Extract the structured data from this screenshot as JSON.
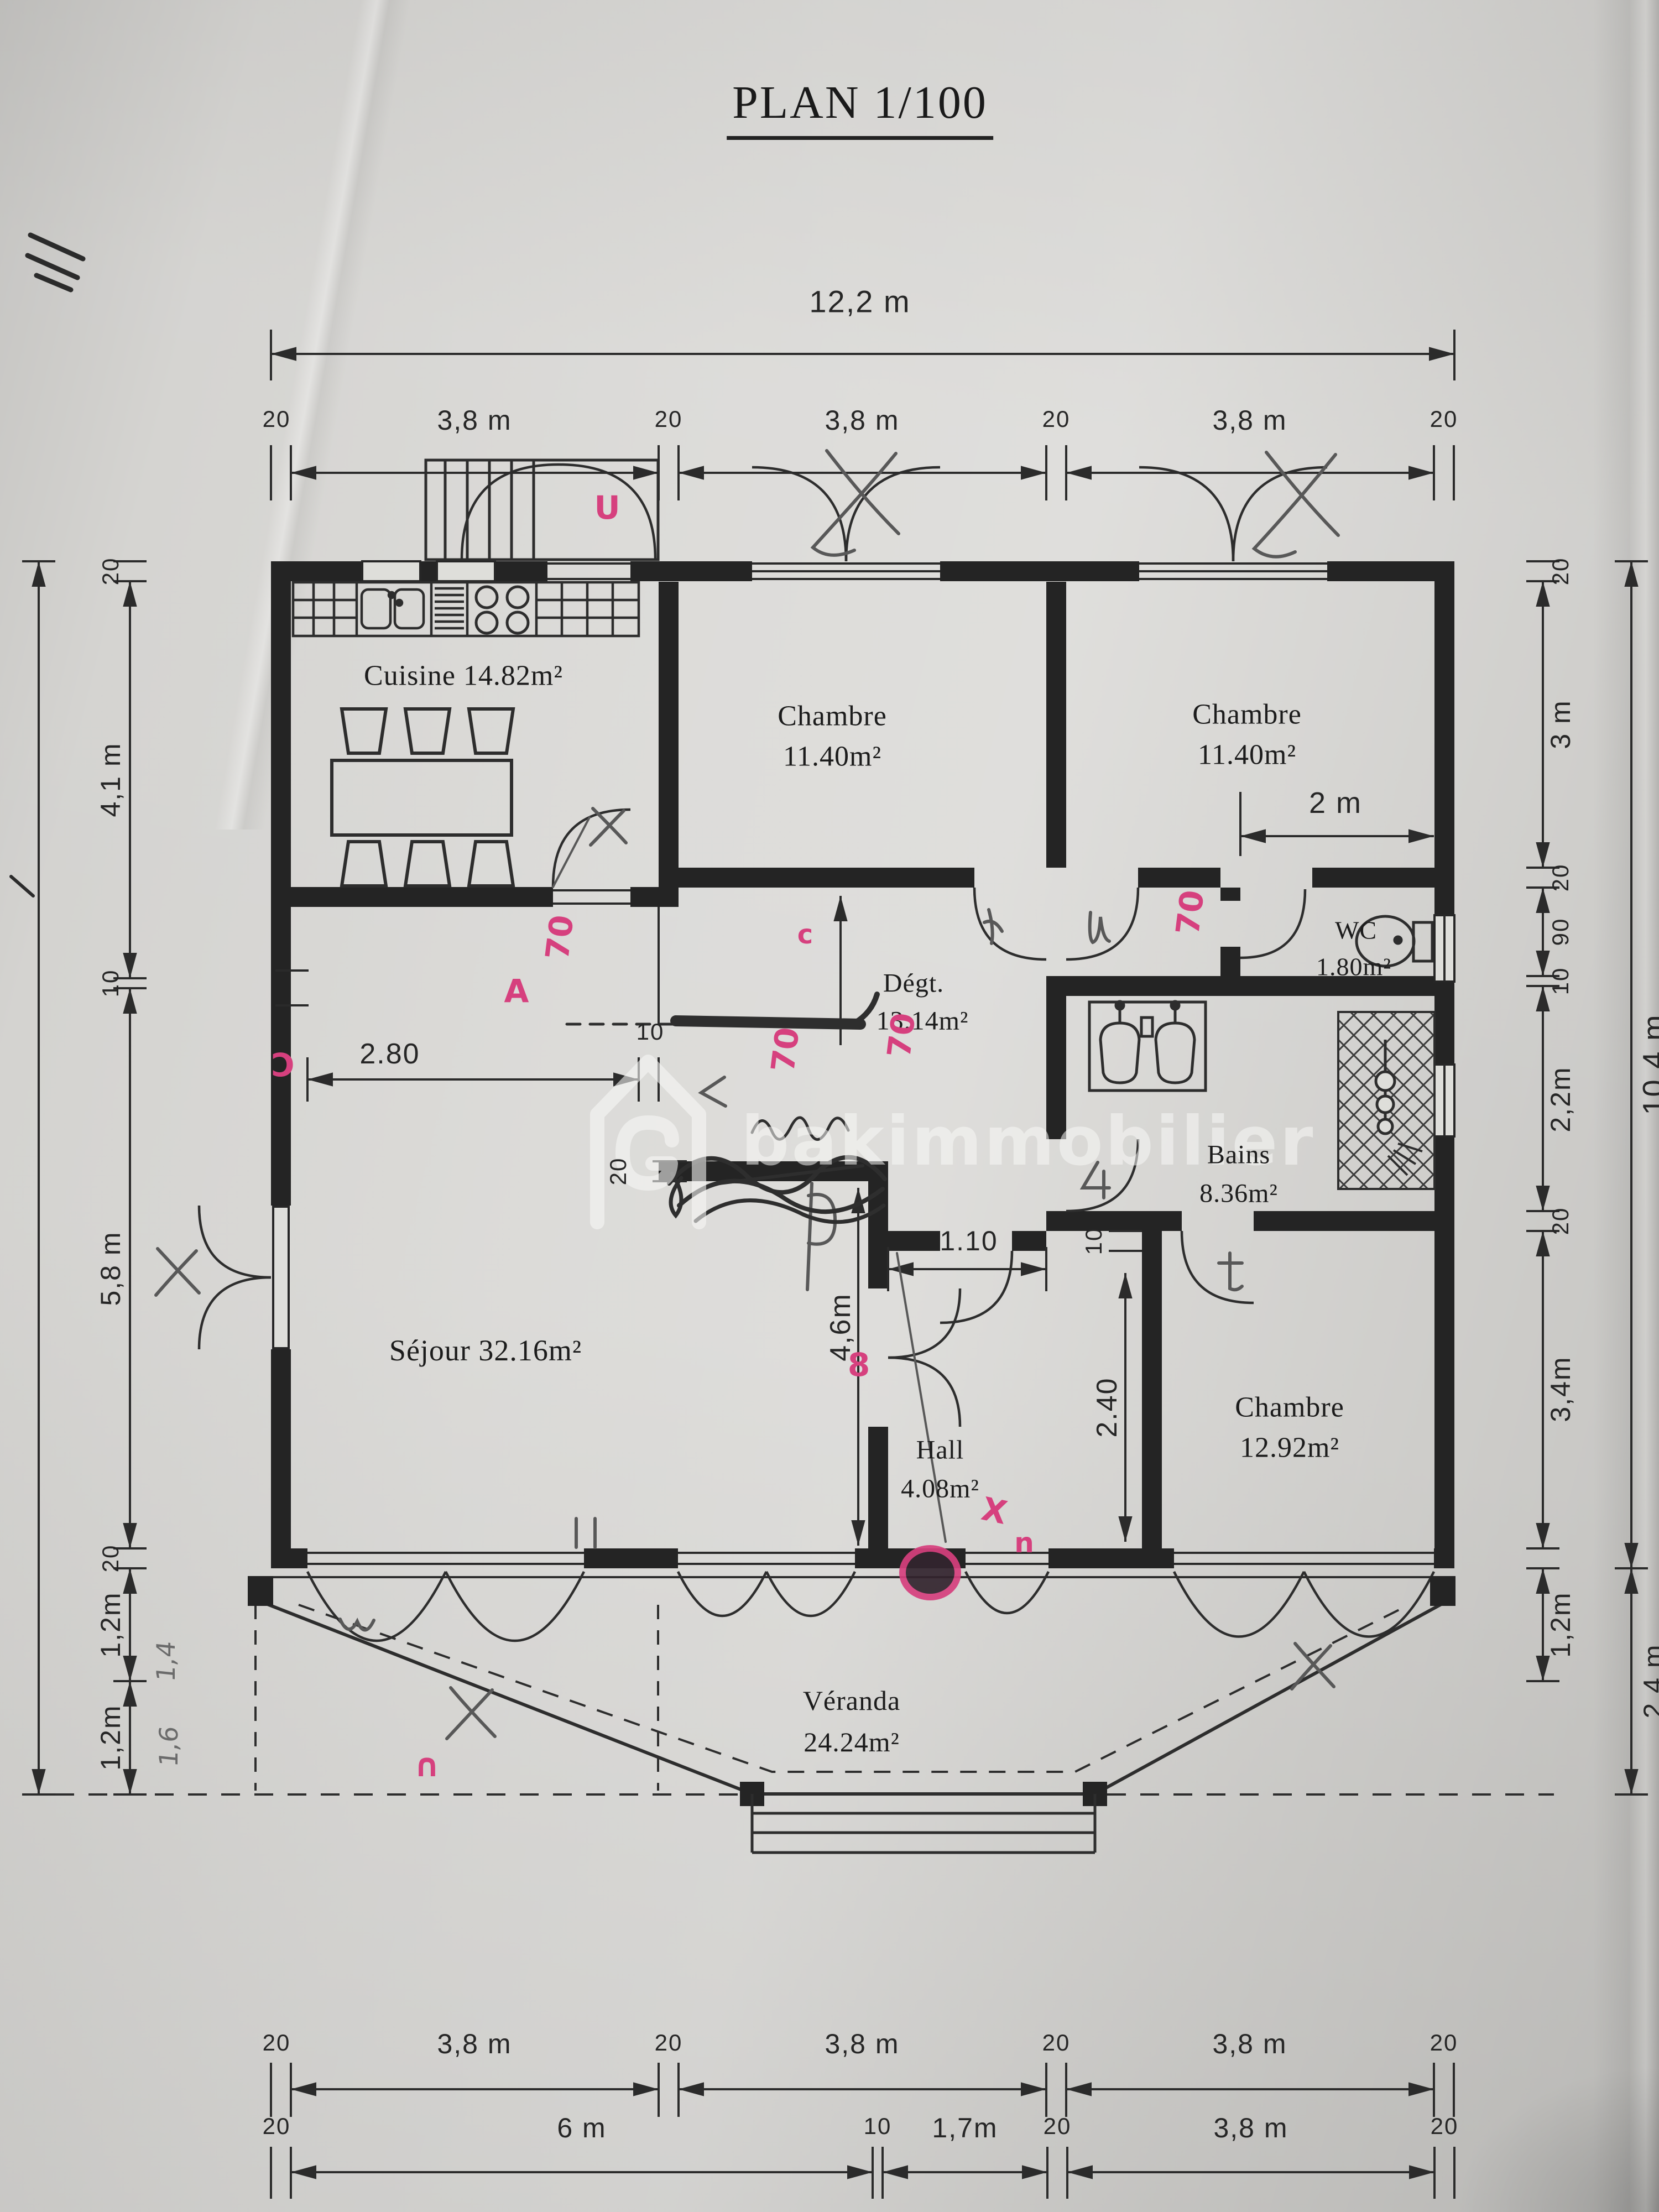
{
  "title": "PLAN 1/100",
  "dims": {
    "top_total": "12,2 m",
    "top_row": [
      "20",
      "3,8 m",
      "20",
      "3,8 m",
      "20",
      "3,8 m",
      "20"
    ],
    "bottom_row1": [
      "20",
      "3,8 m",
      "20",
      "3,8 m",
      "20",
      "3,8 m",
      "20"
    ],
    "bottom_row2": [
      "20",
      "6 m",
      "10",
      "1,7m",
      "20",
      "3,8 m",
      "20"
    ],
    "left_col": [
      "20",
      "4,1 m",
      "10",
      "5,8 m",
      "20",
      "1,2m",
      "1,2m"
    ],
    "right_col": [
      "20",
      "3 m",
      "20",
      "90",
      "10",
      "2,2m",
      "20",
      "3,4m",
      "1,2m"
    ],
    "right_outer": [
      "10,4 m",
      "2,4 m"
    ],
    "interior": {
      "chambre2_width": "2 m",
      "sejour_wall_offset": "2.80",
      "offset_wall_thickness": "10",
      "wall_thickness": "20",
      "corridor_width": "1.10",
      "hall_depth": "4,6m",
      "hall_wall_thickness": "10",
      "chambre3_recess": "2.40"
    }
  },
  "rooms": {
    "cuisine": {
      "label": "Cuisine 14.82m²"
    },
    "chambre_top_middle": {
      "name": "Chambre",
      "area": "11.40m²"
    },
    "chambre_top_right": {
      "name": "Chambre",
      "area": "11.40m²"
    },
    "wc": {
      "name": "WC",
      "area": "1.80m²"
    },
    "degagement": {
      "name": "Dégt.",
      "area": "13.14m²"
    },
    "bains": {
      "name": "Bains",
      "area": "8.36m²"
    },
    "sejour": {
      "label": "Séjour 32.16m²"
    },
    "hall": {
      "name": "Hall",
      "area": "4.08m²"
    },
    "chambre_bottom_right": {
      "name": "Chambre",
      "area": "12.92m²"
    },
    "veranda": {
      "name": "Véranda",
      "area": "24.24m²"
    }
  },
  "annotations": {
    "pink_door_width": "70",
    "pink_marks": {
      "porch": "U",
      "sejour_a": "A",
      "open_paren": "Ɔ",
      "small_c": "c",
      "eight": "8",
      "x_mark": "X",
      "n_mark": "n",
      "arch": "∩"
    },
    "pencil_notes": {
      "left_12_a": "1,4",
      "left_12_b": "1,6"
    }
  },
  "watermark": {
    "text": "bakimmobilier"
  }
}
